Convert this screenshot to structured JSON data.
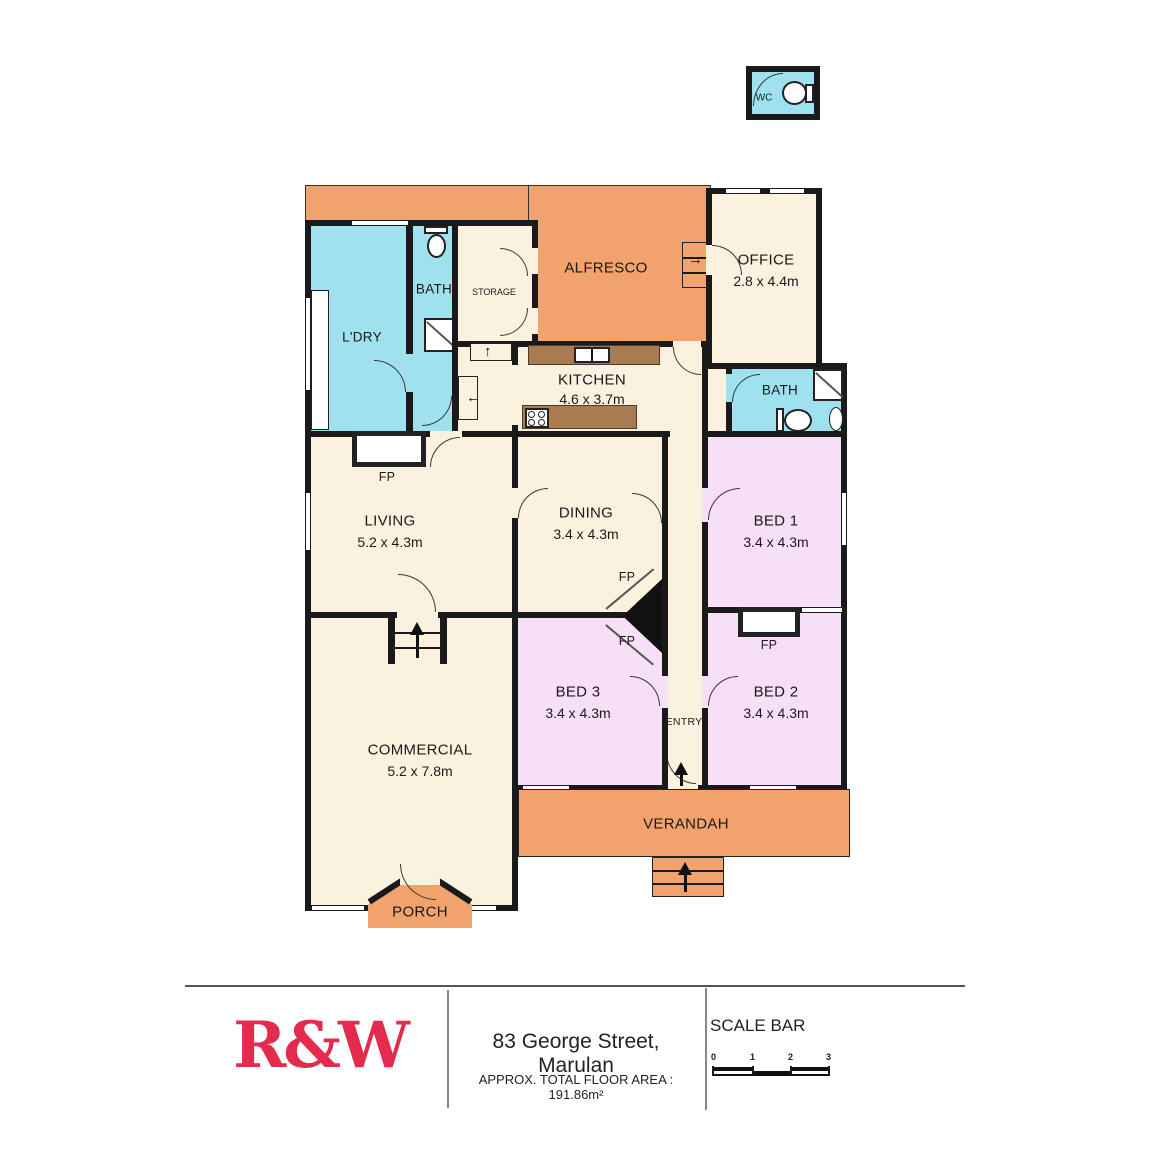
{
  "plan": {
    "rooms": {
      "wc": {
        "label": "WC"
      },
      "alfresco": {
        "label": "ALFRESCO"
      },
      "office": {
        "label": "OFFICE",
        "dims": "2.8 x 4.4m"
      },
      "ldry": {
        "label": "L'DRY"
      },
      "bath_upper": {
        "label": "BATH"
      },
      "storage": {
        "label": "STORAGE"
      },
      "kitchen": {
        "label": "KITCHEN",
        "dims": "4.6 x 3.7m"
      },
      "bath_right": {
        "label": "BATH"
      },
      "living": {
        "label": "LIVING",
        "dims": "5.2 x 4.3m"
      },
      "dining": {
        "label": "DINING",
        "dims": "3.4 x 4.3m"
      },
      "bed1": {
        "label": "BED 1",
        "dims": "3.4 x 4.3m"
      },
      "bed2": {
        "label": "BED 2",
        "dims": "3.4 x 4.3m"
      },
      "bed3": {
        "label": "BED 3",
        "dims": "3.4 x 4.3m"
      },
      "entry": {
        "label": "ENTRY"
      },
      "commercial": {
        "label": "COMMERCIAL",
        "dims": "5.2 x 7.8m"
      },
      "verandah": {
        "label": "VERANDAH"
      },
      "porch": {
        "label": "PORCH"
      }
    },
    "fp_label": "FP",
    "arrows": {
      "up": "↑",
      "left": "←",
      "right": "→"
    }
  },
  "footer": {
    "logo": "R&W",
    "address": "83 George Street, Marulan",
    "area": "APPROX. TOTAL FLOOR AREA : 191.86m²",
    "scale": {
      "title": "SCALE BAR",
      "ticks": [
        "0",
        "1",
        "2",
        "3"
      ]
    }
  },
  "colors": {
    "outdoor_orange": "#F2A26C",
    "interior_cream": "#FAF2DF",
    "wet_area_blue": "#9FE1EF",
    "bedroom_pink": "#F8DFF8",
    "bench_brown": "#A87C50",
    "wall_black": "#1a1a1a",
    "logo_red": "#E42A4D"
  }
}
